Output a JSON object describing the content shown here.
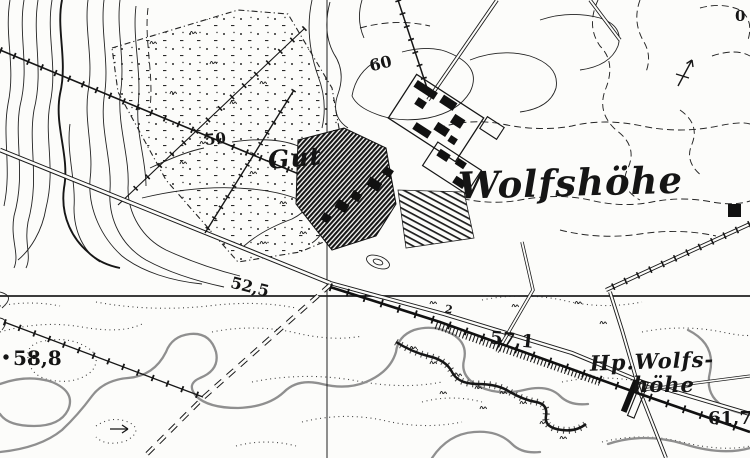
{
  "map": {
    "settlement_label": "Wolfshöhe",
    "estate_label": "Gut",
    "halt_label_line1": "Hp.Wolfs-",
    "halt_label_line2": "höhe",
    "spot_heights": {
      "southwest": "58,8",
      "crossing": "52,5",
      "midline": "57,1",
      "southeast": "61,7"
    },
    "contour_labels": {
      "west_hill": "50",
      "north_hill": "60"
    },
    "edge_labels": {
      "top_right_partial": "0",
      "small_south": "2"
    },
    "colors": {
      "ink": "#1c1c1c",
      "paper": "#fcfcfa",
      "gray_contour": "#8f8f8f"
    }
  }
}
